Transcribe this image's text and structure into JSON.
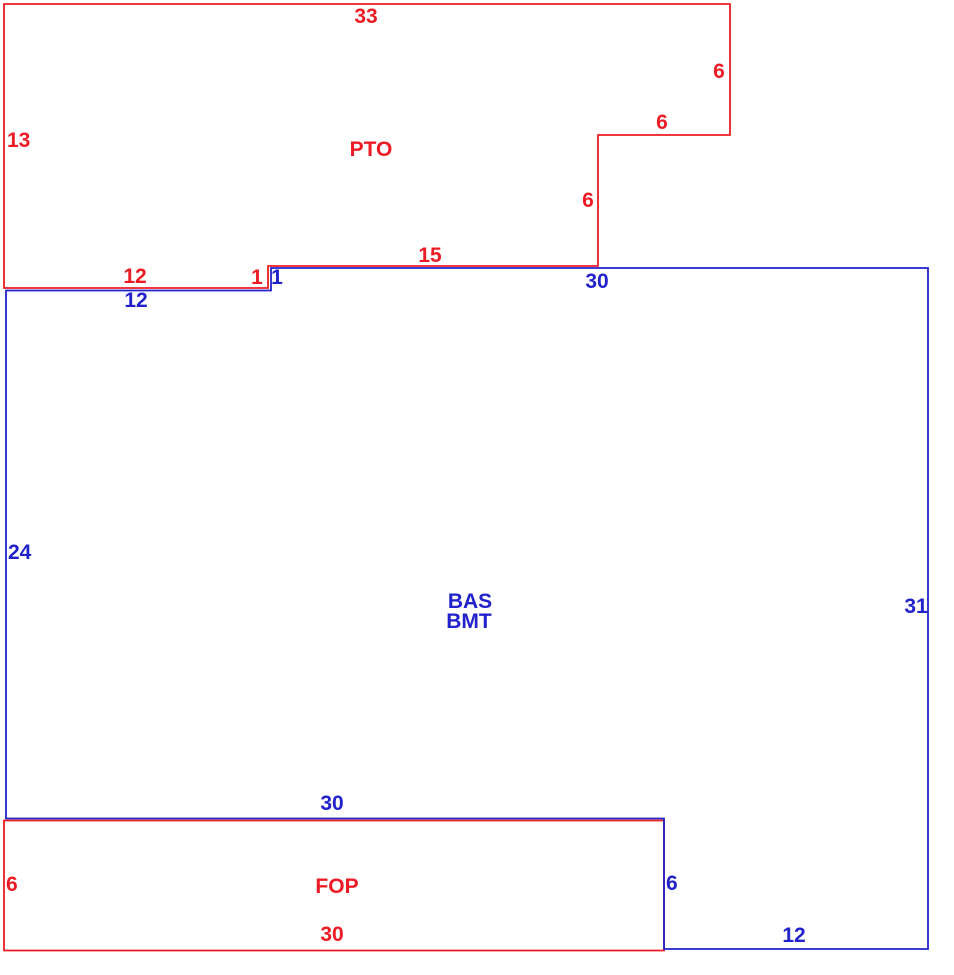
{
  "colors": {
    "red": "#ed1c24",
    "blue": "#2222cc"
  },
  "pto": {
    "label": "PTO",
    "dims": {
      "top": "33",
      "left": "13",
      "right": "6",
      "notch_top": "6",
      "notch_side": "6",
      "bottom_mid": "15",
      "step": "1",
      "bottom_left": "12"
    }
  },
  "bas": {
    "label_line1": "BAS",
    "label_line2": "BMT",
    "dims": {
      "top_left": "12",
      "step": "1",
      "top": "30",
      "left": "24",
      "right": "31",
      "mid": "30",
      "notch_side": "6",
      "bottom": "12"
    }
  },
  "fop": {
    "label": "FOP",
    "dims": {
      "left": "6",
      "bottom": "30"
    }
  }
}
